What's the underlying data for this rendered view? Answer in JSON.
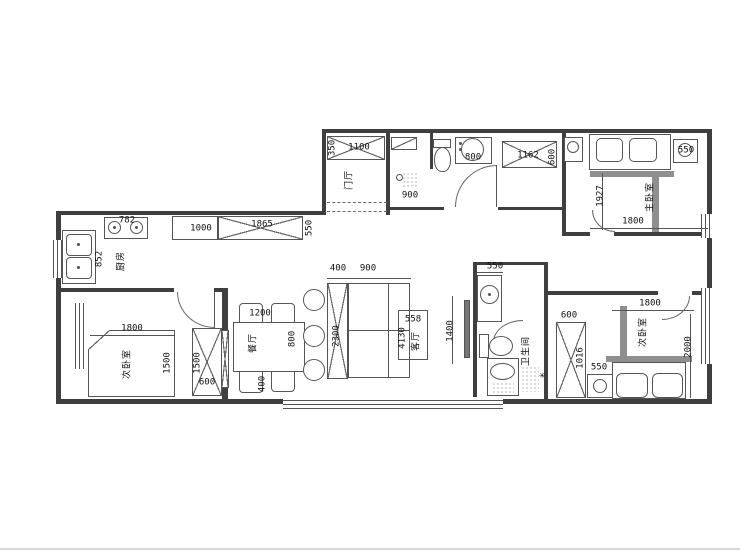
{
  "rooms": {
    "entry": "门厅",
    "kitchen": "厨房",
    "bedroom_left": "次卧室",
    "dining": "餐厅",
    "living": "客厅",
    "bathroom": "卫生间",
    "bedroom_right": "次卧室",
    "master": "主卧室"
  },
  "dims": {
    "entry_closet_w": "1100",
    "entry_closet_d": "350",
    "hall_w": "900",
    "vanity_w": "800",
    "window_top_w": "1162",
    "window_top_h": "600",
    "master_nightstand": "550",
    "master_depth": "1927",
    "master_width": "1800",
    "stove_w": "782",
    "sink_run": "852",
    "cabinet_a": "1000",
    "cabinet_b": "1865",
    "cabinet_d": "550",
    "bl_width": "1800",
    "bl_bed": "1500",
    "bl_ward_h": "1500",
    "bl_ward_w": "600",
    "table_w": "1200",
    "table_d": "800",
    "dining_gap": "400",
    "sofa_chaise": "400",
    "sofa_w": "900",
    "sofa_len": "2300",
    "living_a": "558",
    "living_b": "4130",
    "tv_w": "1400",
    "bath_niche": "550",
    "br_ward_w": "600",
    "br_ward_h": "1016",
    "br_nightstand": "550",
    "br_width": "1800",
    "br_depth": "2000"
  },
  "colors": {
    "wall": "#3f3f3f",
    "beam": "#8f8f8f",
    "line": "#555555",
    "background": "#ffffff"
  }
}
